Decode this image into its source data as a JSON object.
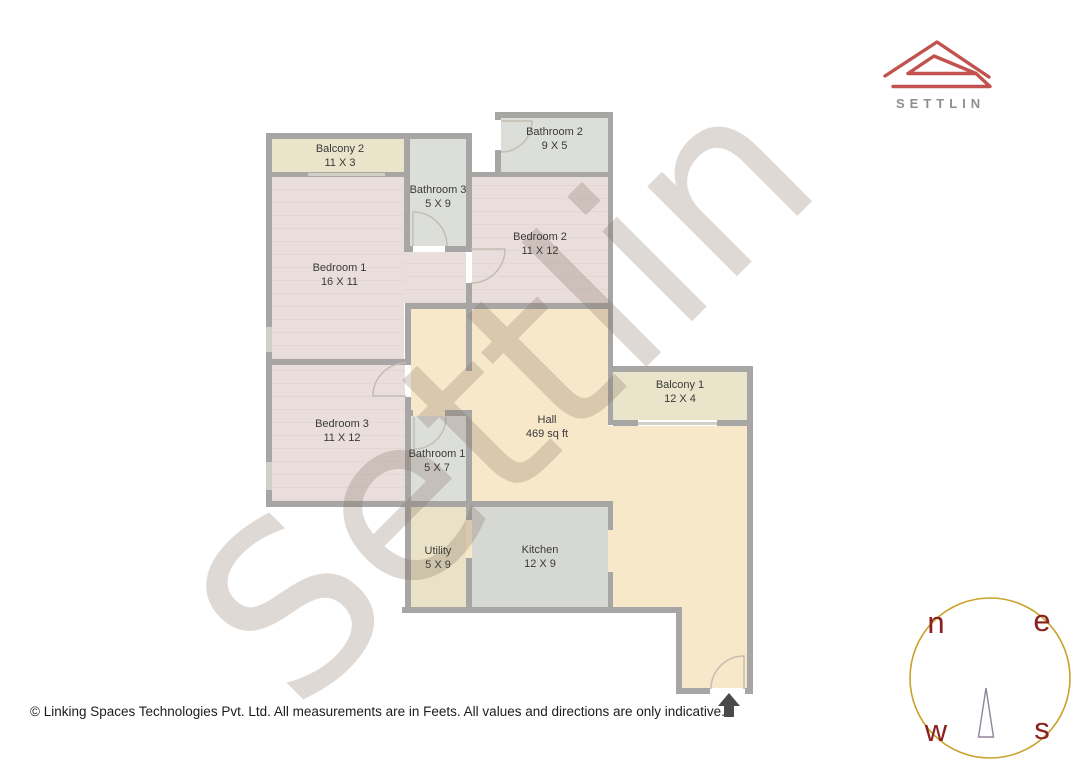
{
  "logo": {
    "brand": "SETTLIN",
    "accent_color": "#c2524e",
    "text_color": "#8f8f8f"
  },
  "watermark": {
    "text": "Settlin"
  },
  "rooms": [
    {
      "id": "balcony2",
      "name": "Balcony 2",
      "size": "11 X 3",
      "fill": "#e9e4ca"
    },
    {
      "id": "bathroom3",
      "name": "Bathroom 3",
      "size": "5 X 9",
      "fill": "#dcdeda"
    },
    {
      "id": "bathroom2",
      "name": "Bathroom 2",
      "size": "9 X 5",
      "fill": "#dcdeda"
    },
    {
      "id": "bedroom1",
      "name": "Bedroom 1",
      "size": "16 X 11",
      "fill": "#e9dedc"
    },
    {
      "id": "bedroom2",
      "name": "Bedroom 2",
      "size": "11 X 12",
      "fill": "#e9dedc"
    },
    {
      "id": "bedroom3",
      "name": "Bedroom 3",
      "size": "11 X 12",
      "fill": "#e9dedc"
    },
    {
      "id": "hall",
      "name": "Hall",
      "size": "469 sq ft",
      "fill": "#f8e8ca"
    },
    {
      "id": "balcony1",
      "name": "Balcony 1",
      "size": "12 X 4",
      "fill": "#e9e4ca"
    },
    {
      "id": "bathroom1",
      "name": "Bathroom 1",
      "size": "5 X 7",
      "fill": "#dcdeda"
    },
    {
      "id": "utility",
      "name": "Utility",
      "size": "5 X 9",
      "fill": "#e9e2c6"
    },
    {
      "id": "kitchen",
      "name": "Kitchen",
      "size": "12 X 9",
      "fill": "#d6d8d3"
    }
  ],
  "compass": {
    "north": "n",
    "east": "e",
    "west": "w",
    "south": "s",
    "ring_color": "#c9a22a",
    "letter_color": "#8b2020",
    "needle_color": "#90849a"
  },
  "entrance": {
    "symbol": "up-arrow",
    "color": "#4a4a4a"
  },
  "colors": {
    "wall": "#a7a6a4",
    "hall": "#f8e8ca",
    "bedroom": "#e9dedc",
    "bathroom": "#dcdeda",
    "kitchen": "#d6d8d3",
    "balcony": "#e9e4ca",
    "utility": "#e9e2c6"
  },
  "footer": {
    "text": "© Linking Spaces Technologies Pvt. Ltd. All measurements are in Feets. All values and directions are only indicative."
  }
}
